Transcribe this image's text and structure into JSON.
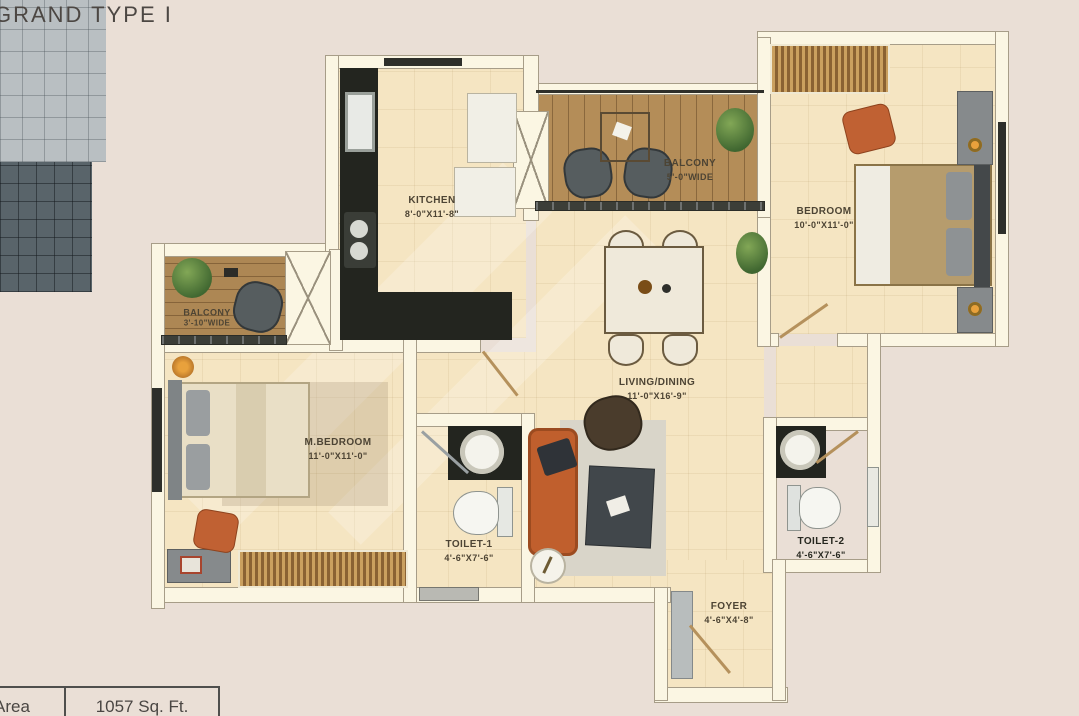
{
  "page": {
    "title": "GRAND TYPE I"
  },
  "rooms": [
    {
      "name": "KITCHEN",
      "dims": "8'-0\"X11'-8\""
    },
    {
      "name": "BALCONY",
      "dims": "5'-0\"WIDE"
    },
    {
      "name": "BEDROOM",
      "dims": "10'-0\"X11'-0\""
    },
    {
      "name": "BALCONY",
      "dims": "3'-10\"WIDE"
    },
    {
      "name": "M.BEDROOM",
      "dims": "11'-0\"X11'-0\""
    },
    {
      "name": "LIVING/DINING",
      "dims": "11'-0\"X16'-9\""
    },
    {
      "name": "TOILET-1",
      "dims": "4'-6\"X7'-6\""
    },
    {
      "name": "TOILET-2",
      "dims": "4'-6\"X7'-6\""
    },
    {
      "name": "FOYER",
      "dims": "4'-6\"X4'-8\""
    }
  ],
  "area_table": {
    "label": "Area",
    "value": "1057 Sq. Ft."
  },
  "colors": {
    "background": "#eadfd6",
    "floor": "#f5e5c2",
    "wall": "#fbf6e3",
    "balcony_wood": "#b48d58",
    "kitchen_counter": "#23251f",
    "accent_orange": "#c06133",
    "toilet1_floor": "#b9bfc2",
    "toilet2_floor": "#59646a"
  }
}
